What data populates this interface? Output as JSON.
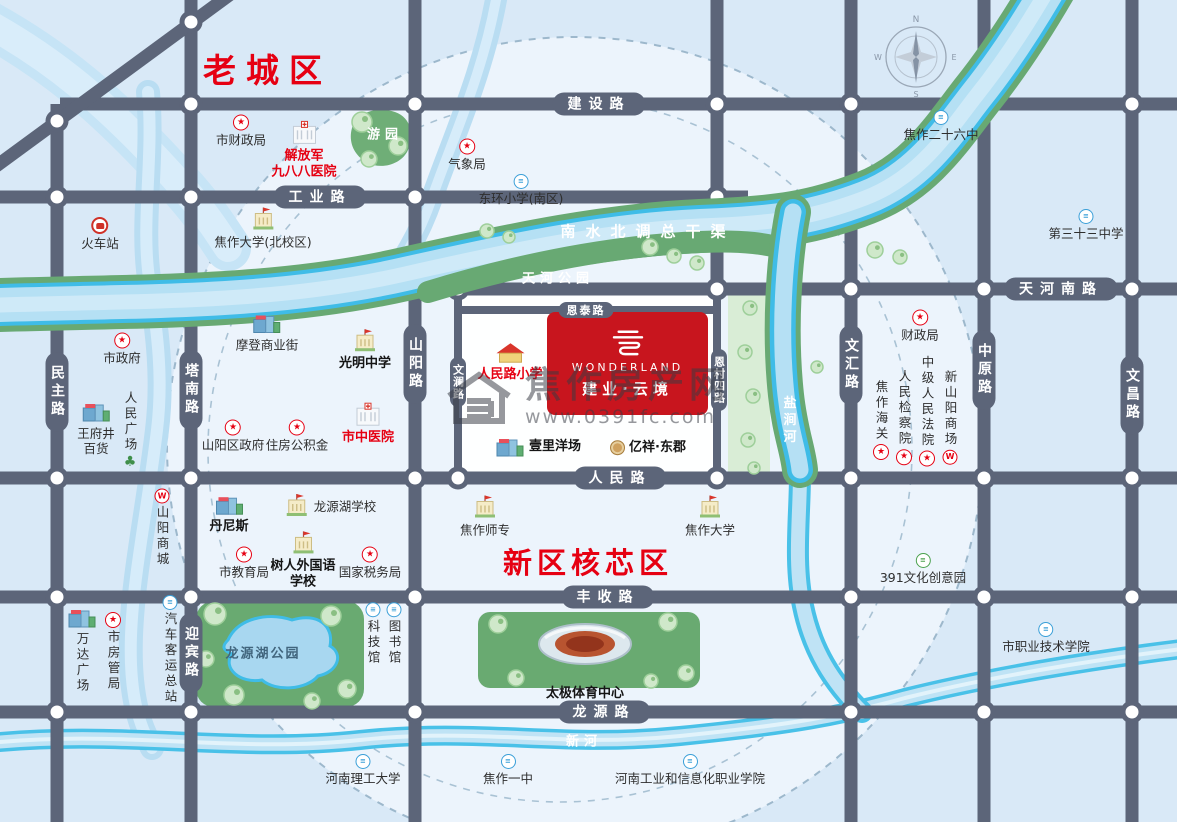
{
  "map": {
    "title": "焦作建业云境区位图",
    "regions": [
      {
        "id": "old-town",
        "label": "老城区",
        "x": 203,
        "y": 44,
        "size": 33,
        "ls": 10
      },
      {
        "id": "new-core",
        "label": "新区核芯区",
        "x": 503,
        "y": 540,
        "size": 29,
        "ls": 5
      }
    ],
    "project": {
      "brand": "WONDERLAND",
      "name": "建业·云境"
    },
    "watermark": {
      "title": "焦作房产网",
      "url": "www.0391fc.com"
    },
    "compass": {
      "n": "N",
      "e": "E",
      "s": "S",
      "w": "W"
    },
    "icons": {
      "star": "★",
      "badge": "≡",
      "mall": "W",
      "tree": "♣"
    },
    "road_labels": [
      {
        "name": "jianshe-road",
        "text": "建设路",
        "x": 599,
        "y": 104,
        "v": false,
        "small": false
      },
      {
        "name": "gongye-road",
        "text": "工业路",
        "x": 320,
        "y": 197,
        "v": false,
        "small": false
      },
      {
        "name": "tianhe-south-road",
        "text": "天河南路",
        "x": 1061,
        "y": 289,
        "v": false,
        "small": false
      },
      {
        "name": "renmin-road",
        "text": "人民路",
        "x": 620,
        "y": 478,
        "v": false,
        "small": false
      },
      {
        "name": "fengshou-road",
        "text": "丰收路",
        "x": 608,
        "y": 597,
        "v": false,
        "small": false
      },
      {
        "name": "longyuan-road",
        "text": "龙源路",
        "x": 604,
        "y": 712,
        "v": false,
        "small": false
      },
      {
        "name": "entai-road",
        "text": "恩泰路",
        "x": 586,
        "y": 310,
        "v": false,
        "small": true
      },
      {
        "name": "minzhu-road",
        "text": "民主路",
        "x": 57,
        "y": 392,
        "v": true,
        "small": false
      },
      {
        "name": "tanan-road",
        "text": "塔南路",
        "x": 191,
        "y": 390,
        "v": true,
        "small": false
      },
      {
        "name": "yingbin-road",
        "text": "迎宾路",
        "x": 191,
        "y": 653,
        "v": true,
        "small": false
      },
      {
        "name": "shanyang-road",
        "text": "山阳路",
        "x": 415,
        "y": 364,
        "v": true,
        "small": false
      },
      {
        "name": "wenlan-road",
        "text": "文澜路",
        "x": 458,
        "y": 382,
        "v": true,
        "small": true
      },
      {
        "name": "encun-4th-road",
        "text": "恩村四路",
        "x": 719,
        "y": 380,
        "v": true,
        "small": true
      },
      {
        "name": "wenhui-road",
        "text": "文汇路",
        "x": 851,
        "y": 365,
        "v": true,
        "small": false
      },
      {
        "name": "zhongyuan-road",
        "text": "中原路",
        "x": 984,
        "y": 370,
        "v": true,
        "small": false
      },
      {
        "name": "wenchang-road",
        "text": "文昌路",
        "x": 1132,
        "y": 395,
        "v": true,
        "small": false
      }
    ],
    "river_labels": [
      {
        "name": "south-north-water-canal",
        "text": "南水北调总干渠",
        "x": 648,
        "y": 231,
        "cls": "big"
      },
      {
        "name": "tianhe-park",
        "text": "天河公园",
        "x": 558,
        "y": 277,
        "cls": "sp"
      },
      {
        "name": "yanjian-river",
        "text": "盐涧河",
        "x": 788,
        "y": 421,
        "cls": "v"
      },
      {
        "name": "xin-river",
        "text": "新河",
        "x": 584,
        "y": 740,
        "cls": "sp"
      },
      {
        "name": "youyuan-garden",
        "text": "游园",
        "x": 385,
        "y": 133,
        "cls": "sp"
      },
      {
        "name": "longyuanhu-park",
        "text": "龙源湖公园",
        "x": 263,
        "y": 652,
        "cls": "dark"
      }
    ],
    "pois": [
      {
        "id": "city-finance-bureau-north",
        "label": "市财政局",
        "x": 241,
        "y": 131,
        "icon": "star",
        "pos": "above"
      },
      {
        "id": "pla-988-hospital",
        "lines": [
          "解放军",
          "九八八医院"
        ],
        "x": 304,
        "y": 150,
        "icon": "bldg-hospital",
        "pos": "above",
        "style": "red"
      },
      {
        "id": "weather-bureau",
        "label": "气象局",
        "x": 467,
        "y": 155,
        "icon": "star",
        "pos": "above"
      },
      {
        "id": "donghuan-primary-south",
        "label": "东环小学(南区)",
        "x": 521,
        "y": 190,
        "icon": "circle-school",
        "pos": "above"
      },
      {
        "id": "railway-station",
        "label": "火车站",
        "x": 100,
        "y": 234,
        "icon": "train",
        "pos": "above"
      },
      {
        "id": "jiaozuo-univ-north-campus",
        "label": "焦作大学(北校区)",
        "x": 263,
        "y": 228,
        "icon": "bldg-school",
        "pos": "above"
      },
      {
        "id": "jiaozuo-no26-middle",
        "label": "焦作二十六中",
        "x": 941,
        "y": 126,
        "icon": "circle-school",
        "pos": "above"
      },
      {
        "id": "no33-middle-school",
        "label": "第三十三中学",
        "x": 1086,
        "y": 225,
        "icon": "circle-school",
        "pos": "above"
      },
      {
        "id": "city-government",
        "label": "市政府",
        "x": 122,
        "y": 349,
        "icon": "star",
        "pos": "above"
      },
      {
        "id": "wangfujing-dept-store",
        "lines": [
          "王府井",
          "百货"
        ],
        "x": 96,
        "y": 428,
        "icon": "bldg-commercial",
        "pos": "above"
      },
      {
        "id": "renmin-square",
        "label": "人民广场",
        "x": 130,
        "y": 430,
        "icon": "tree",
        "pos": "below",
        "v": true
      },
      {
        "id": "modern-commercial-street",
        "label": "摩登商业街",
        "x": 267,
        "y": 332,
        "icon": "bldg-commercial",
        "pos": "above"
      },
      {
        "id": "guangming-middle",
        "label": "光明中学",
        "x": 365,
        "y": 350,
        "icon": "bldg-school",
        "pos": "above",
        "style": "bold"
      },
      {
        "id": "shanyang-district-govt",
        "label": "山阳区政府",
        "x": 233,
        "y": 436,
        "icon": "star",
        "pos": "above"
      },
      {
        "id": "housing-provident-fund",
        "label": "住房公积金",
        "x": 297,
        "y": 436,
        "icon": "star",
        "pos": "above"
      },
      {
        "id": "city-tcm-hospital",
        "label": "市中医院",
        "x": 368,
        "y": 424,
        "icon": "bldg-hospital",
        "pos": "above",
        "style": "red"
      },
      {
        "id": "renminlu-primary",
        "label": "人民路小学",
        "x": 510,
        "y": 362,
        "icon": "bldg-redroof",
        "pos": "above",
        "style": "red"
      },
      {
        "id": "yili-yangchang",
        "label": "壹里洋场",
        "x": 538,
        "y": 447,
        "icon": "bldg-commercial",
        "pos": "left",
        "style": "bold"
      },
      {
        "id": "yixiang-dongjun",
        "label": "亿祥·东郡",
        "x": 648,
        "y": 448,
        "icon": "gold",
        "pos": "left",
        "style": "bold"
      },
      {
        "id": "finance-bureau",
        "label": "财政局",
        "x": 920,
        "y": 326,
        "icon": "star",
        "pos": "above"
      },
      {
        "id": "jiaozuo-customs",
        "label": "焦作海关",
        "x": 881,
        "y": 420,
        "icon": "star",
        "pos": "below",
        "v": true
      },
      {
        "id": "peoples-procuratorate",
        "label": "人民检察院",
        "x": 904,
        "y": 417,
        "icon": "star",
        "pos": "below",
        "v": true
      },
      {
        "id": "intermediate-peoples-court",
        "label": "中级人民法院",
        "x": 927,
        "y": 411,
        "icon": "star",
        "pos": "below",
        "v": true
      },
      {
        "id": "new-shanyang-mall",
        "label": "新山阳商场",
        "x": 950,
        "y": 417,
        "icon": "shop",
        "pos": "below",
        "v": true
      },
      {
        "id": "shanyang-mall",
        "label": "山阳商城",
        "x": 162,
        "y": 528,
        "icon": "shop",
        "pos": "above",
        "v": true
      },
      {
        "id": "dennis",
        "label": "丹尼斯",
        "x": 229,
        "y": 514,
        "icon": "bldg-commercial",
        "pos": "above",
        "style": "bold"
      },
      {
        "id": "longyuanhu-school",
        "label": "龙源湖学校",
        "x": 330,
        "y": 506,
        "icon": "bldg-school",
        "pos": "left"
      },
      {
        "id": "city-education-bureau",
        "label": "市教育局",
        "x": 244,
        "y": 563,
        "icon": "star",
        "pos": "above"
      },
      {
        "id": "shuren-foreign-language-school",
        "lines": [
          "树人外国语",
          "学校"
        ],
        "x": 303,
        "y": 560,
        "icon": "bldg-school",
        "pos": "above",
        "style": "bold"
      },
      {
        "id": "national-tax-bureau",
        "label": "国家税务局",
        "x": 370,
        "y": 563,
        "icon": "star",
        "pos": "above"
      },
      {
        "id": "jiaozuo-normal-college",
        "label": "焦作师专",
        "x": 485,
        "y": 516,
        "icon": "bldg-school",
        "pos": "above"
      },
      {
        "id": "jiaozuo-university",
        "label": "焦作大学",
        "x": 710,
        "y": 516,
        "icon": "bldg-school",
        "pos": "above"
      },
      {
        "id": "culture-creative-park-391",
        "label": "391文化创意园",
        "x": 923,
        "y": 569,
        "icon": "circle-green",
        "pos": "above"
      },
      {
        "id": "wanda-plaza",
        "label": "万达广场",
        "x": 82,
        "y": 650,
        "icon": "bldg-commercial",
        "pos": "above",
        "v": true
      },
      {
        "id": "city-housing-bureau",
        "label": "市房管局",
        "x": 113,
        "y": 652,
        "icon": "star",
        "pos": "above",
        "v": true
      },
      {
        "id": "bus-terminal",
        "label": "汽车客运总站",
        "x": 170,
        "y": 650,
        "icon": "circle-civic",
        "pos": "above",
        "v": true
      },
      {
        "id": "science-museum",
        "label": "科技馆",
        "x": 373,
        "y": 634,
        "icon": "circle-civic",
        "pos": "above",
        "v": true
      },
      {
        "id": "library",
        "label": "图书馆",
        "x": 394,
        "y": 634,
        "icon": "circle-civic",
        "pos": "above",
        "v": true
      },
      {
        "id": "taiji-sports-center",
        "label": "太极体育中心",
        "x": 585,
        "y": 694,
        "icon": "none",
        "style": "bold"
      },
      {
        "id": "henan-polytechnic-univ",
        "label": "河南理工大学",
        "x": 363,
        "y": 770,
        "icon": "circle-school",
        "pos": "above"
      },
      {
        "id": "jiaozuo-no1-middle",
        "label": "焦作一中",
        "x": 508,
        "y": 770,
        "icon": "circle-school",
        "pos": "above"
      },
      {
        "id": "henan-industry-info-college",
        "label": "河南工业和信息化职业学院",
        "x": 690,
        "y": 770,
        "icon": "circle-school",
        "pos": "above"
      },
      {
        "id": "city-vocational-tech-college",
        "label": "市职业技术学院",
        "x": 1046,
        "y": 638,
        "icon": "circle-school",
        "pos": "above"
      }
    ]
  }
}
